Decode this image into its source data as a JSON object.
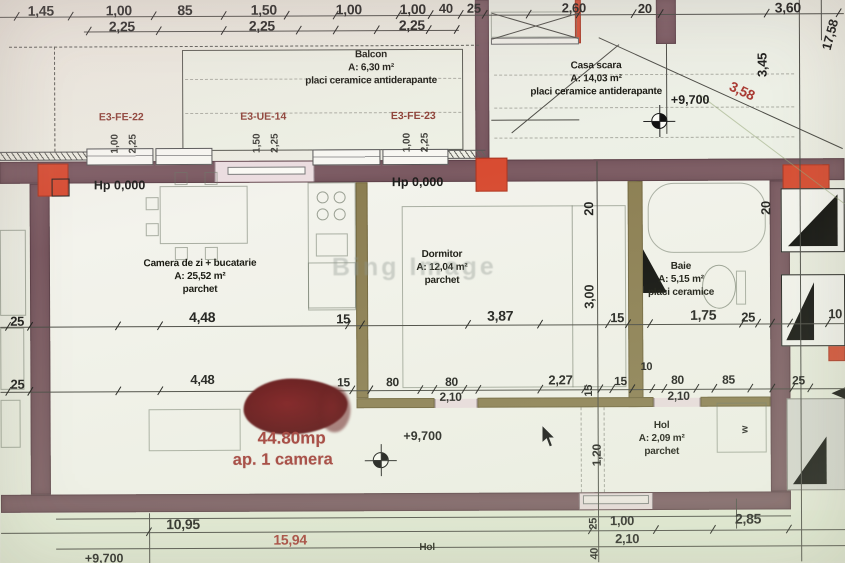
{
  "colors": {
    "wall": "#7b5a62",
    "partition": "#8c7e52",
    "column_red": "#d84b31",
    "marker_red": "#6a1215",
    "annotation_red": "#a23a36",
    "dim_text": "#1d1d1b"
  },
  "marker": {
    "area": "44.80mp",
    "label": "ap. 1 camera"
  },
  "watermark": "Bing Image",
  "rooms": [
    {
      "name": "Balcon",
      "area": "A: 6,30 m²",
      "finish": "placi ceramice antiderapante",
      "cx": 372,
      "cy": 48
    },
    {
      "name": "Casa scara",
      "area": "A: 14,03 m²",
      "finish": "placi ceramice antiderapante",
      "cx": 597,
      "cy": 60
    },
    {
      "name": "Camera de zi + bucatarie",
      "area": "A: 25,52 m²",
      "finish": "parchet",
      "cx": 200,
      "cy": 256
    },
    {
      "name": "Dormitor",
      "area": "A: 12,04 m²",
      "finish": "parchet",
      "cx": 442,
      "cy": 248
    },
    {
      "name": "Baie",
      "area": "A: 5,15 m²",
      "finish": "placi ceramice",
      "cx": 681,
      "cy": 261
    },
    {
      "name": "Hol",
      "area": "A: 2,09 m²",
      "finish": "parchet",
      "cx": 661,
      "cy": 420
    },
    {
      "name": "Hol",
      "area": "",
      "finish": "",
      "cx": 426,
      "cy": 541
    }
  ],
  "levels": [
    {
      "t": "Hp 0,000",
      "x": 120,
      "y": 177
    },
    {
      "t": "Hp 0,000",
      "x": 418,
      "y": 175
    },
    {
      "t": "+9,700",
      "x": 691,
      "y": 94
    },
    {
      "t": "+9,700",
      "x": 422,
      "y": 429
    },
    {
      "t": "+9,700",
      "x": 103,
      "y": 550
    }
  ],
  "windows": [
    {
      "code": "E3-FE-22",
      "dim1": "1,00",
      "dim2": "2,25",
      "cx": 122,
      "cy": 111
    },
    {
      "code": "E3-UE-14",
      "dim1": "1,50",
      "dim2": "2,25",
      "cx": 264,
      "cy": 111
    },
    {
      "code": "E3-FE-23",
      "dim1": "1,00",
      "dim2": "2,25",
      "cx": 414,
      "cy": 111
    }
  ],
  "dims": [
    {
      "t": "1,45",
      "x": 42,
      "y": 2,
      "s": 14
    },
    {
      "t": "1,00",
      "x": 120,
      "y": 2,
      "s": 14
    },
    {
      "t": "85",
      "x": 186,
      "y": 2,
      "s": 14
    },
    {
      "t": "1,50",
      "x": 265,
      "y": 2,
      "s": 14
    },
    {
      "t": "1,00",
      "x": 350,
      "y": 2,
      "s": 14
    },
    {
      "t": "1,00",
      "x": 414,
      "y": 2,
      "s": 14
    },
    {
      "t": "40",
      "x": 447,
      "y": 2,
      "s": 13
    },
    {
      "t": "25",
      "x": 475,
      "y": 2,
      "s": 13
    },
    {
      "t": "2,60",
      "x": 575,
      "y": 2,
      "s": 13
    },
    {
      "t": "20",
      "x": 646,
      "y": 3,
      "s": 13
    },
    {
      "t": "3,60",
      "x": 789,
      "y": 2,
      "s": 14
    },
    {
      "t": "17,58",
      "x": 831,
      "y": 30,
      "rot": -75,
      "s": 13
    },
    {
      "t": "2,25",
      "x": 123,
      "y": 18,
      "s": 14
    },
    {
      "t": "2,25",
      "x": 263,
      "y": 18,
      "s": 14
    },
    {
      "t": "2,25",
      "x": 413,
      "y": 18,
      "s": 14
    },
    {
      "t": "3,45",
      "x": 763,
      "y": 60,
      "rot": -90,
      "s": 13
    },
    {
      "t": "3,58",
      "x": 743,
      "y": 85,
      "rot": 25,
      "c": "red",
      "s": 14
    },
    {
      "t": "20",
      "x": 589,
      "y": 203,
      "rot": -90,
      "s": 13
    },
    {
      "t": "20",
      "x": 766,
      "y": 203,
      "rot": -90,
      "s": 13
    },
    {
      "t": "3,00",
      "x": 589,
      "y": 291,
      "rot": -90,
      "s": 13
    },
    {
      "t": "25",
      "x": 17,
      "y": 313,
      "s": 13
    },
    {
      "t": "4,48",
      "x": 202,
      "y": 309,
      "s": 14
    },
    {
      "t": "15",
      "x": 343,
      "y": 312,
      "s": 13
    },
    {
      "t": "3,87",
      "x": 500,
      "y": 309,
      "s": 14
    },
    {
      "t": "15",
      "x": 617,
      "y": 312,
      "s": 13
    },
    {
      "t": "1,75",
      "x": 703,
      "y": 309,
      "s": 14
    },
    {
      "t": "25",
      "x": 748,
      "y": 312,
      "s": 13
    },
    {
      "t": "10",
      "x": 835,
      "y": 309,
      "s": 13
    },
    {
      "t": "25",
      "x": 17,
      "y": 376,
      "s": 13
    },
    {
      "t": "4,48",
      "x": 202,
      "y": 372,
      "s": 13
    },
    {
      "t": "15",
      "x": 343,
      "y": 376,
      "s": 12
    },
    {
      "t": "80",
      "x": 392,
      "y": 376,
      "s": 12
    },
    {
      "t": "80",
      "x": 451,
      "y": 376,
      "s": 12
    },
    {
      "t": "2,10",
      "x": 450,
      "y": 391,
      "s": 12
    },
    {
      "t": "2,27",
      "x": 560,
      "y": 374,
      "s": 13
    },
    {
      "t": "15",
      "x": 589,
      "y": 386,
      "rot": -90,
      "s": 11
    },
    {
      "t": "15",
      "x": 620,
      "y": 376,
      "s": 12
    },
    {
      "t": "10",
      "x": 646,
      "y": 363,
      "s": 11
    },
    {
      "t": "80",
      "x": 677,
      "y": 375,
      "s": 12
    },
    {
      "t": "2,10",
      "x": 678,
      "y": 391,
      "s": 12
    },
    {
      "t": "85",
      "x": 728,
      "y": 375,
      "s": 12
    },
    {
      "t": "25",
      "x": 798,
      "y": 376,
      "s": 12
    },
    {
      "t": "1,20",
      "x": 596,
      "y": 450,
      "rot": -90,
      "s": 12
    },
    {
      "t": "w",
      "x": 745,
      "y": 426,
      "rot": -90,
      "s": 10
    },
    {
      "t": "10,95",
      "x": 182,
      "y": 516,
      "s": 14
    },
    {
      "t": "15,94",
      "x": 289,
      "y": 532,
      "c": "red",
      "s": 14
    },
    {
      "t": "25",
      "x": 593,
      "y": 519,
      "rot": -90,
      "s": 11
    },
    {
      "t": "1,00",
      "x": 621,
      "y": 515,
      "s": 13
    },
    {
      "t": "2,10",
      "x": 626,
      "y": 533,
      "s": 13
    },
    {
      "t": "40",
      "x": 594,
      "y": 549,
      "rot": -90,
      "s": 11
    },
    {
      "t": "2,85",
      "x": 747,
      "y": 513,
      "s": 14
    }
  ]
}
